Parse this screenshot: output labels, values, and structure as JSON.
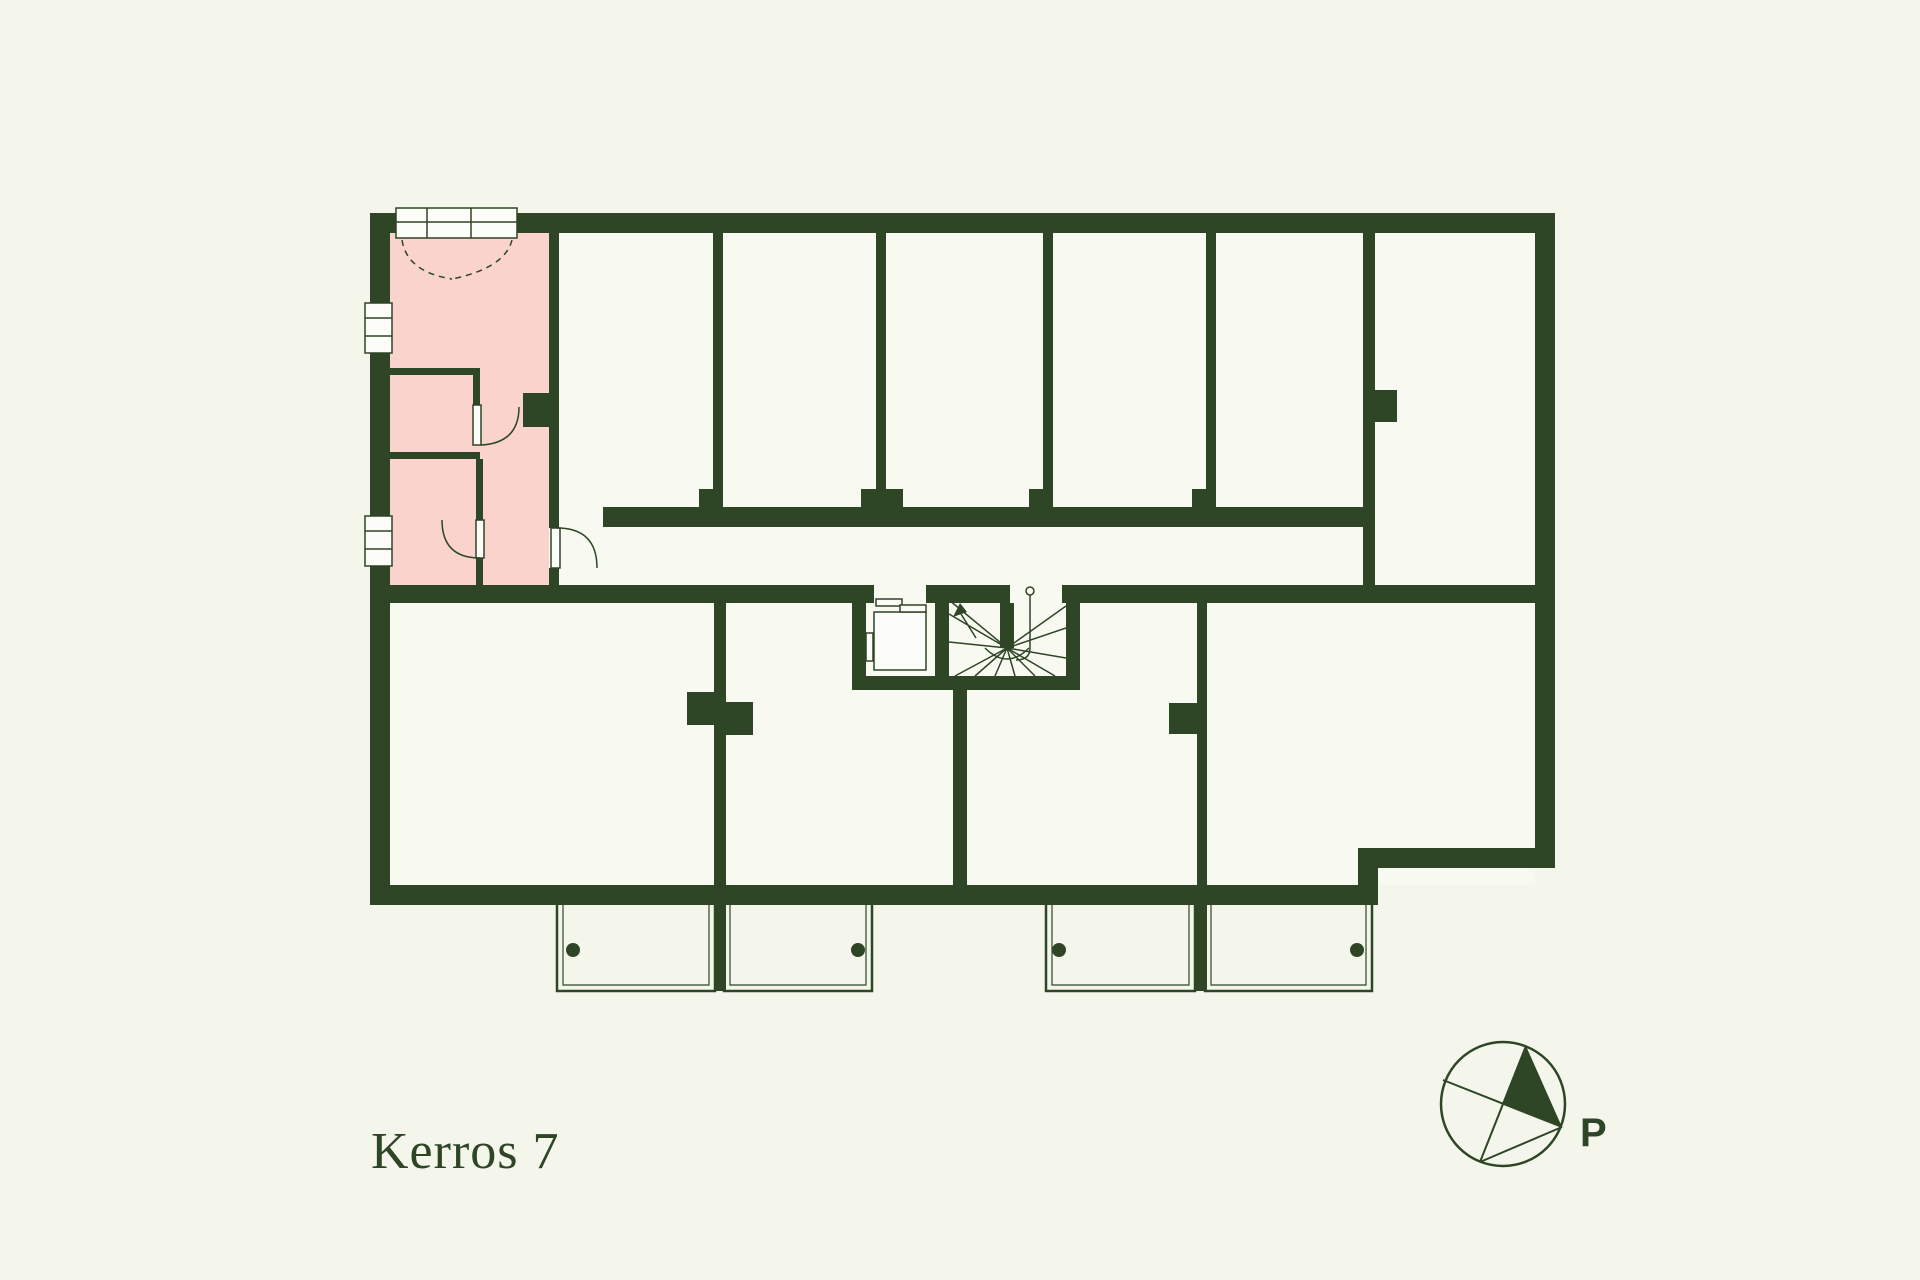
{
  "title": {
    "label": "Kerros 7"
  },
  "compass": {
    "label": "P"
  },
  "theme": {
    "wall": "#2e4526",
    "bg": "#f4f6ec",
    "room": "#f8faf1",
    "highlight": "#f9d3cc",
    "fixture": "#fcfdf8"
  },
  "plan": {
    "highlighted_unit_color": "#f9d3cc",
    "balcony_count": 4,
    "top_room_count": 6
  }
}
